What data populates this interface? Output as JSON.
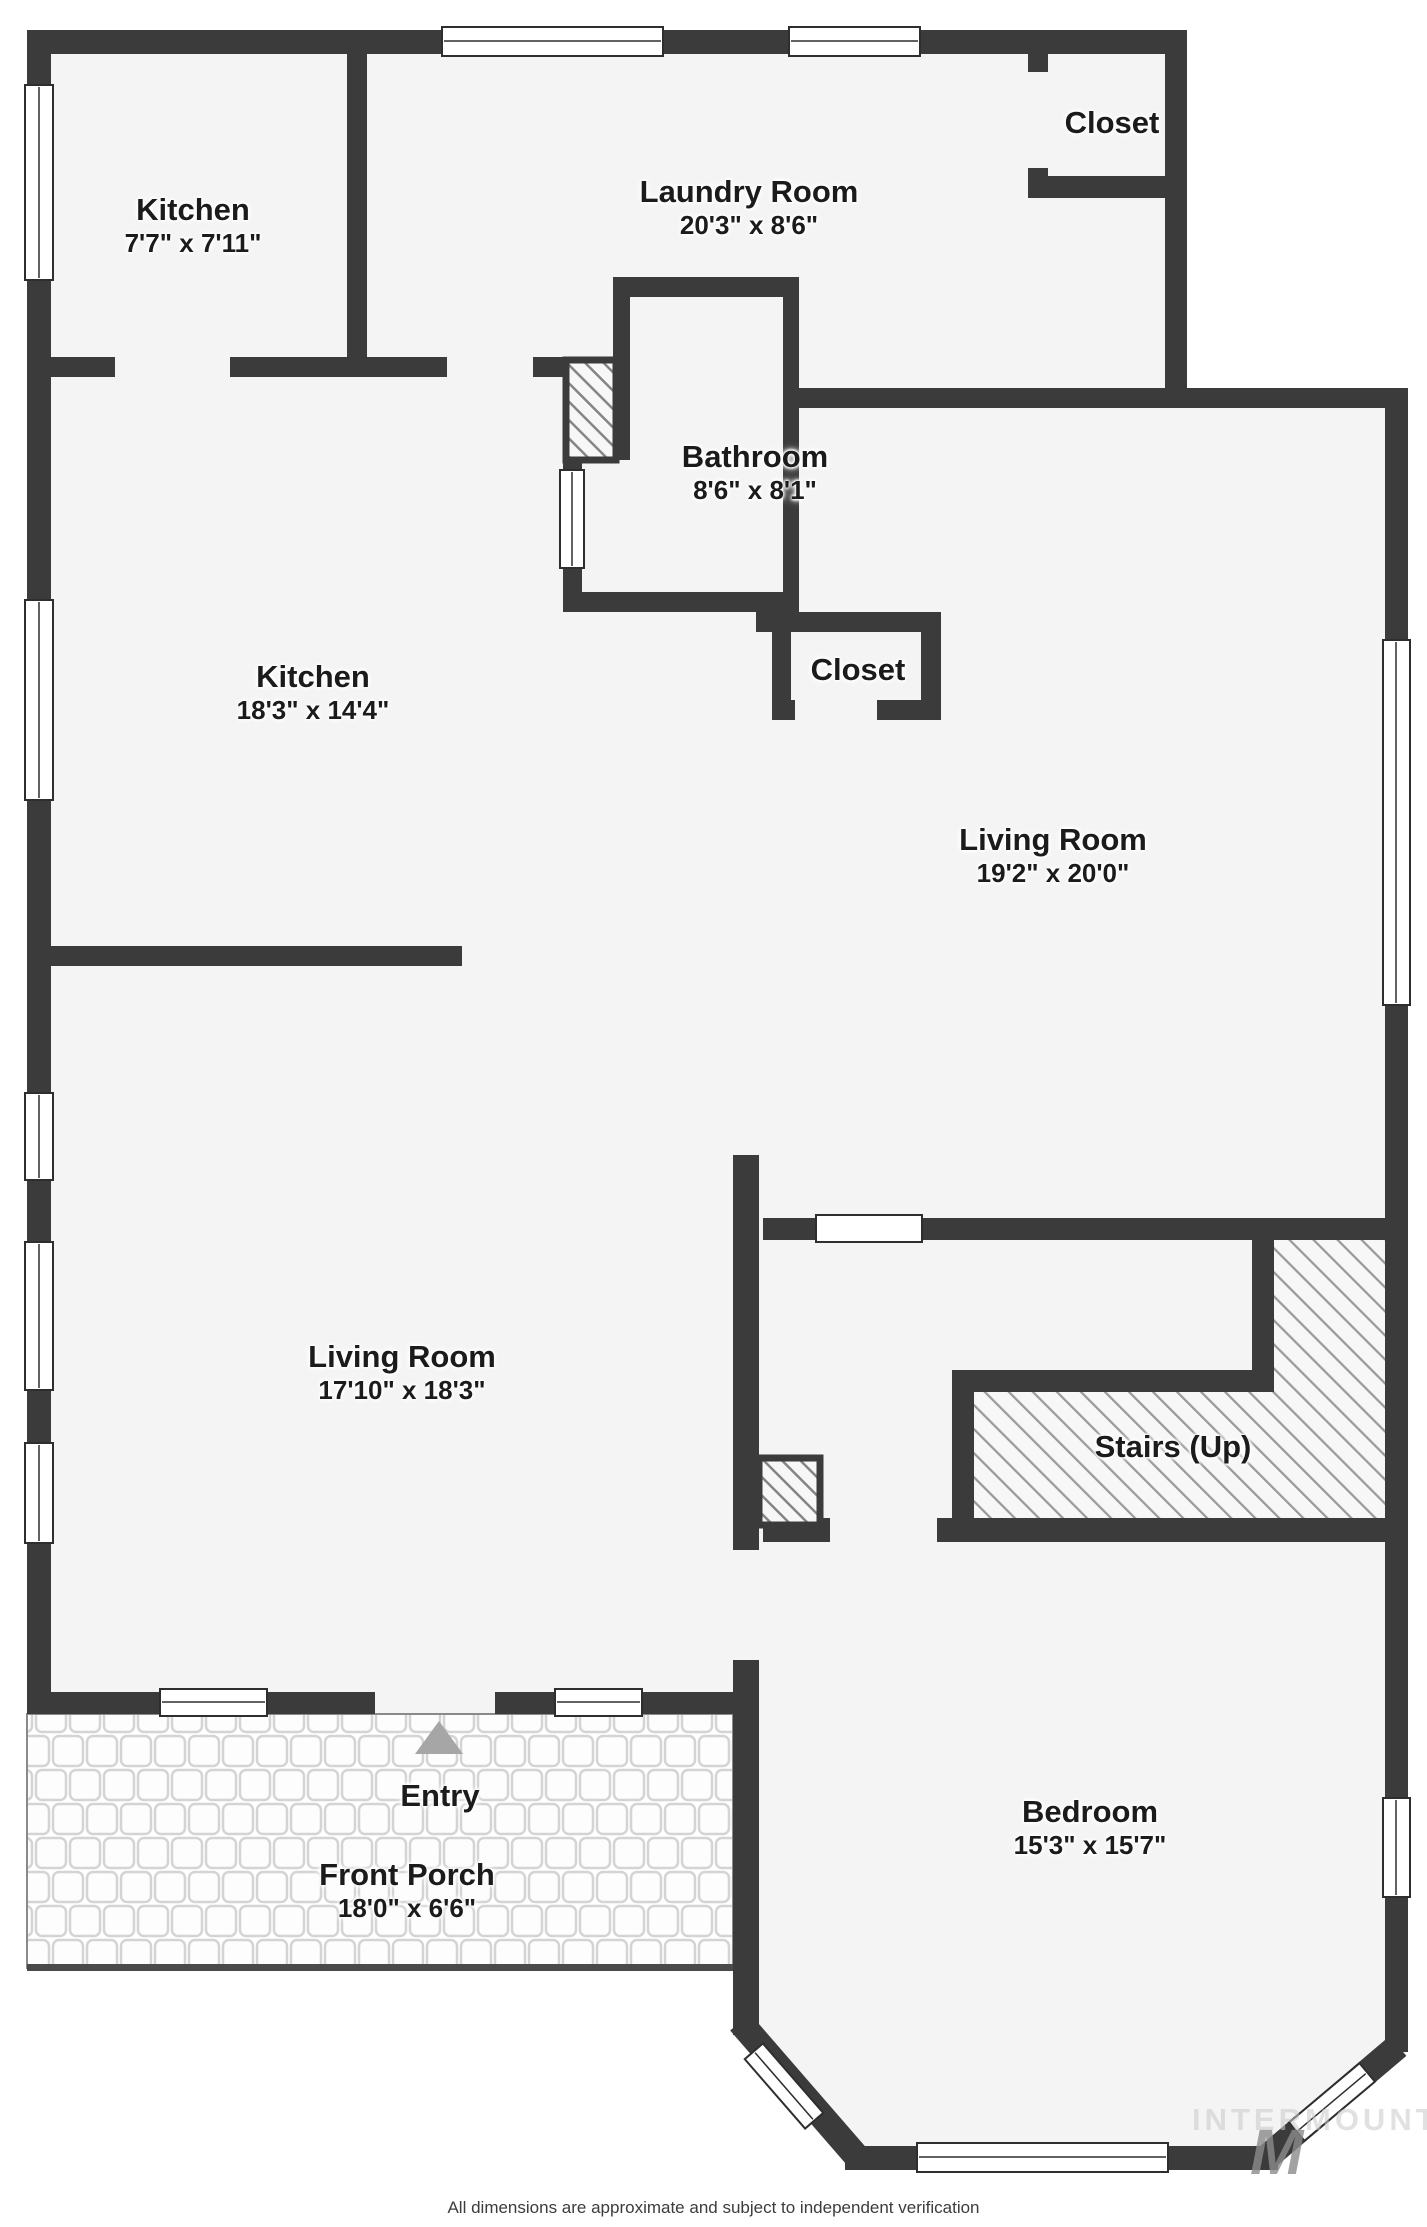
{
  "rooms": [
    {
      "name": "Kitchen",
      "dims": "7'7\" x 7'11\""
    },
    {
      "name": "Laundry Room",
      "dims": "20'3\" x 8'6\""
    },
    {
      "name": "Closet",
      "dims": ""
    },
    {
      "name": "Bathroom",
      "dims": "8'6\" x 8'1\""
    },
    {
      "name": "Kitchen",
      "dims": "18'3\" x 14'4\""
    },
    {
      "name": "Closet",
      "dims": ""
    },
    {
      "name": "Living Room",
      "dims": "19'2\" x 20'0\""
    },
    {
      "name": "Living Room",
      "dims": "17'10\" x 18'3\""
    },
    {
      "name": "Stairs (Up)",
      "dims": ""
    },
    {
      "name": "Bedroom",
      "dims": "15'3\" x 15'7\""
    },
    {
      "name": "Entry",
      "dims": ""
    },
    {
      "name": "Front Porch",
      "dims": "18'0\" x 6'6\""
    }
  ],
  "footer": {
    "disclaimer": "All dimensions are approximate and subject to independent verification"
  },
  "watermark": {
    "text": "INTERMOUNTAIN",
    "logo_letter": "M"
  },
  "colors": {
    "wall": "#3b3b3b",
    "floor": "#f4f4f4",
    "hatch_line": "#9a9a9a",
    "porch_tile_line": "#d4d4d4",
    "entry_arrow": "#a6a6a6",
    "label_text": "#1b1b1b",
    "watermark": "#c9c9c9"
  }
}
